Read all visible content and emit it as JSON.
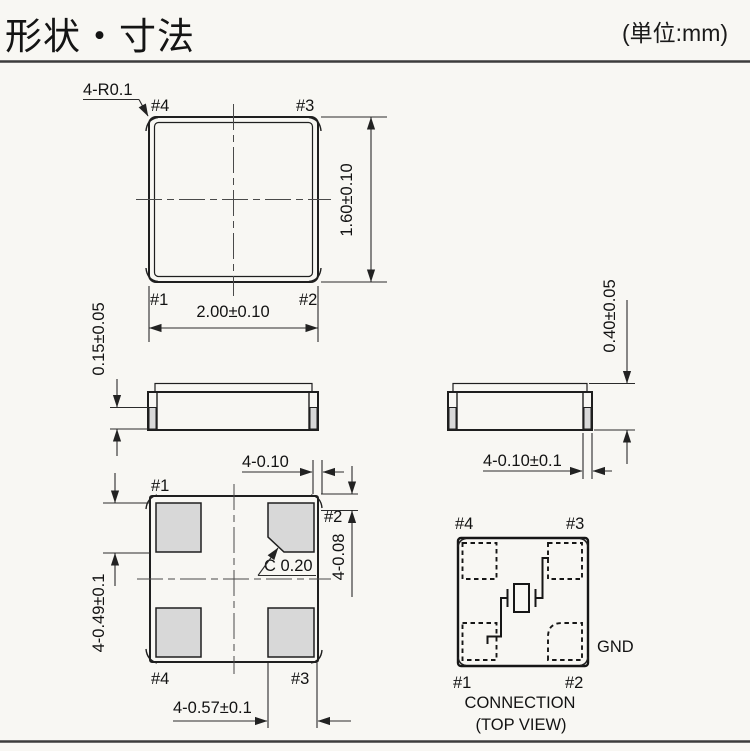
{
  "header": {
    "title": "形状・寸法",
    "unit": "(単位:mm)"
  },
  "colors": {
    "background": "#f8f7f3",
    "line_ink": "#1f1f1f",
    "pad_fill": "#d8d8d8",
    "text_ink": "#131313"
  },
  "top_view": {
    "corner_note": "4-R0.1",
    "pin1": "#1",
    "pin2": "#2",
    "pin3": "#3",
    "pin4": "#4",
    "dim_width": "2.00±0.10",
    "dim_height": "1.60±0.10"
  },
  "side_view_front": {
    "dim_pad_height": "0.15±0.05"
  },
  "side_view_right": {
    "dim_total_height": "0.40±0.05",
    "dim_terminal_width": "4-0.10±0.1"
  },
  "bottom_view": {
    "pin1": "#1",
    "pin2": "#2",
    "pin3": "#3",
    "pin4": "#4",
    "dim_corner_width": "4-0.10",
    "dim_corner_height": "4-0.08",
    "dim_pad_height": "4-0.49±0.1",
    "dim_pad_width": "4-0.57±0.1",
    "chamfer_note": "C 0.20"
  },
  "connection": {
    "pin1": "#1",
    "pin2": "#2",
    "pin3": "#3",
    "pin4": "#4",
    "gnd_label": "GND",
    "caption_line1": "CONNECTION",
    "caption_line2": "(TOP VIEW)"
  }
}
